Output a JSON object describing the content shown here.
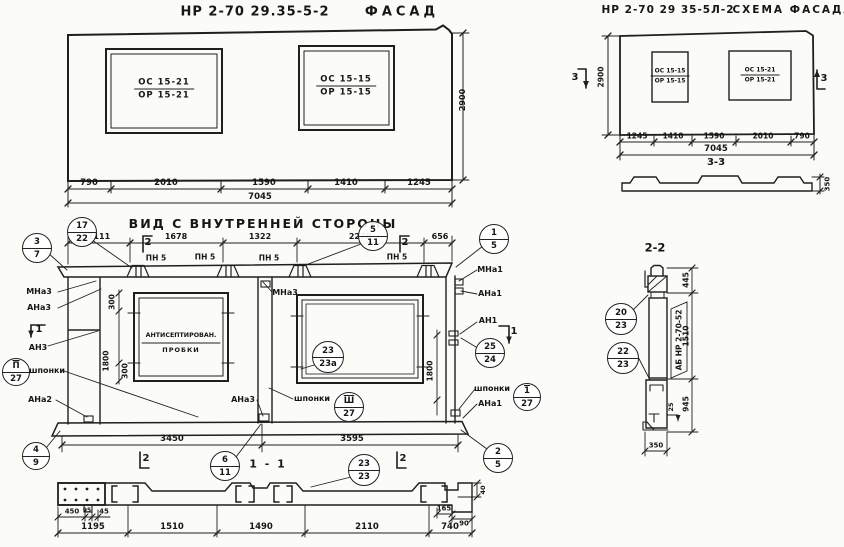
{
  "facade": {
    "code": "НР 2-70 29.35-5-2",
    "name": "ФАСАД",
    "window_left": {
      "top": "ОС 15-21",
      "bottom": "ОР 15-21"
    },
    "window_right": {
      "top": "ОС 15-15",
      "bottom": "ОР 15-15"
    },
    "height_dim": "2900",
    "dims": [
      "790",
      "2010",
      "1590",
      "1410",
      "1245"
    ],
    "total_dim": "7045"
  },
  "schema": {
    "code": "НР 2-70 29 35-5Л-2",
    "name": "СХЕМА ФАСАДА",
    "window_left": {
      "top": "ОС 15-15",
      "bottom": "ОР 15-15"
    },
    "window_right": {
      "top": "ОС 15-21",
      "bottom": "ОР 15-21"
    },
    "height_dim": "2900",
    "section_marker": "3",
    "dims": [
      "1245",
      "1410",
      "1590",
      "2010",
      "790"
    ],
    "total_dim": "7045",
    "section33": {
      "title": "3-3",
      "height_dim": "350"
    }
  },
  "inner": {
    "title": "ВИД С ВНУТРЕННЕЙ СТОРОНЫ",
    "top_dims": [
      "1111",
      "1678",
      "1322",
      "2278",
      "656"
    ],
    "pn_label": "ПН 5",
    "window_note1": "АНТИСЕПТИРОВАН.",
    "window_note2": "ПРОБКИ",
    "labels": {
      "mna3": "МНа3",
      "ana3": "АНа3",
      "an3": "АН3",
      "ana2": "АНа2",
      "mna1": "МНа1",
      "ana1": "АНа1",
      "an1": "АН1",
      "shponki": "шпонки"
    },
    "vdims": {
      "v300": "300",
      "v1800": "1800"
    },
    "bottom_dims": [
      "3450",
      "3595"
    ],
    "marker1": "1",
    "marker2": "2",
    "callouts": {
      "c3_7": {
        "top": "3",
        "bottom": "7"
      },
      "c17_22": {
        "top": "17",
        "bottom": "22"
      },
      "c5_11": {
        "top": "5",
        "bottom": "11"
      },
      "c1_5": {
        "top": "1",
        "bottom": "5"
      },
      "c25_24": {
        "top": "25",
        "bottom": "24"
      },
      "c23_23a": {
        "top": "23",
        "bottom": "23а"
      },
      "cII_27": {
        "top": "П",
        "bottom": "27"
      },
      "cIII_27": {
        "top": "Ш",
        "bottom": "27"
      },
      "cI_27": {
        "top": "1",
        "bottom": "27"
      },
      "c4_9": {
        "top": "4",
        "bottom": "9"
      },
      "c6_11": {
        "top": "6",
        "bottom": "11"
      },
      "c23_23": {
        "top": "23",
        "bottom": "23"
      },
      "c2_5": {
        "top": "2",
        "bottom": "5"
      }
    }
  },
  "section11": {
    "title": "1 - 1",
    "sub_dims_left": [
      "450",
      "95",
      "45"
    ],
    "sub_dims_right": [
      "165",
      "90"
    ],
    "v_dim": "40",
    "dims": [
      "1195",
      "1510",
      "1490",
      "2110",
      "740"
    ]
  },
  "section22": {
    "title": "2-2",
    "dims": {
      "d445": "445",
      "d1510": "1510",
      "d945": "945",
      "d25": "25",
      "d350": "350"
    },
    "stamp": "АБ НР 2-70-52",
    "callouts": {
      "c20_23": {
        "top": "20",
        "bottom": "23"
      },
      "c22_23": {
        "top": "22",
        "bottom": "23"
      }
    }
  }
}
